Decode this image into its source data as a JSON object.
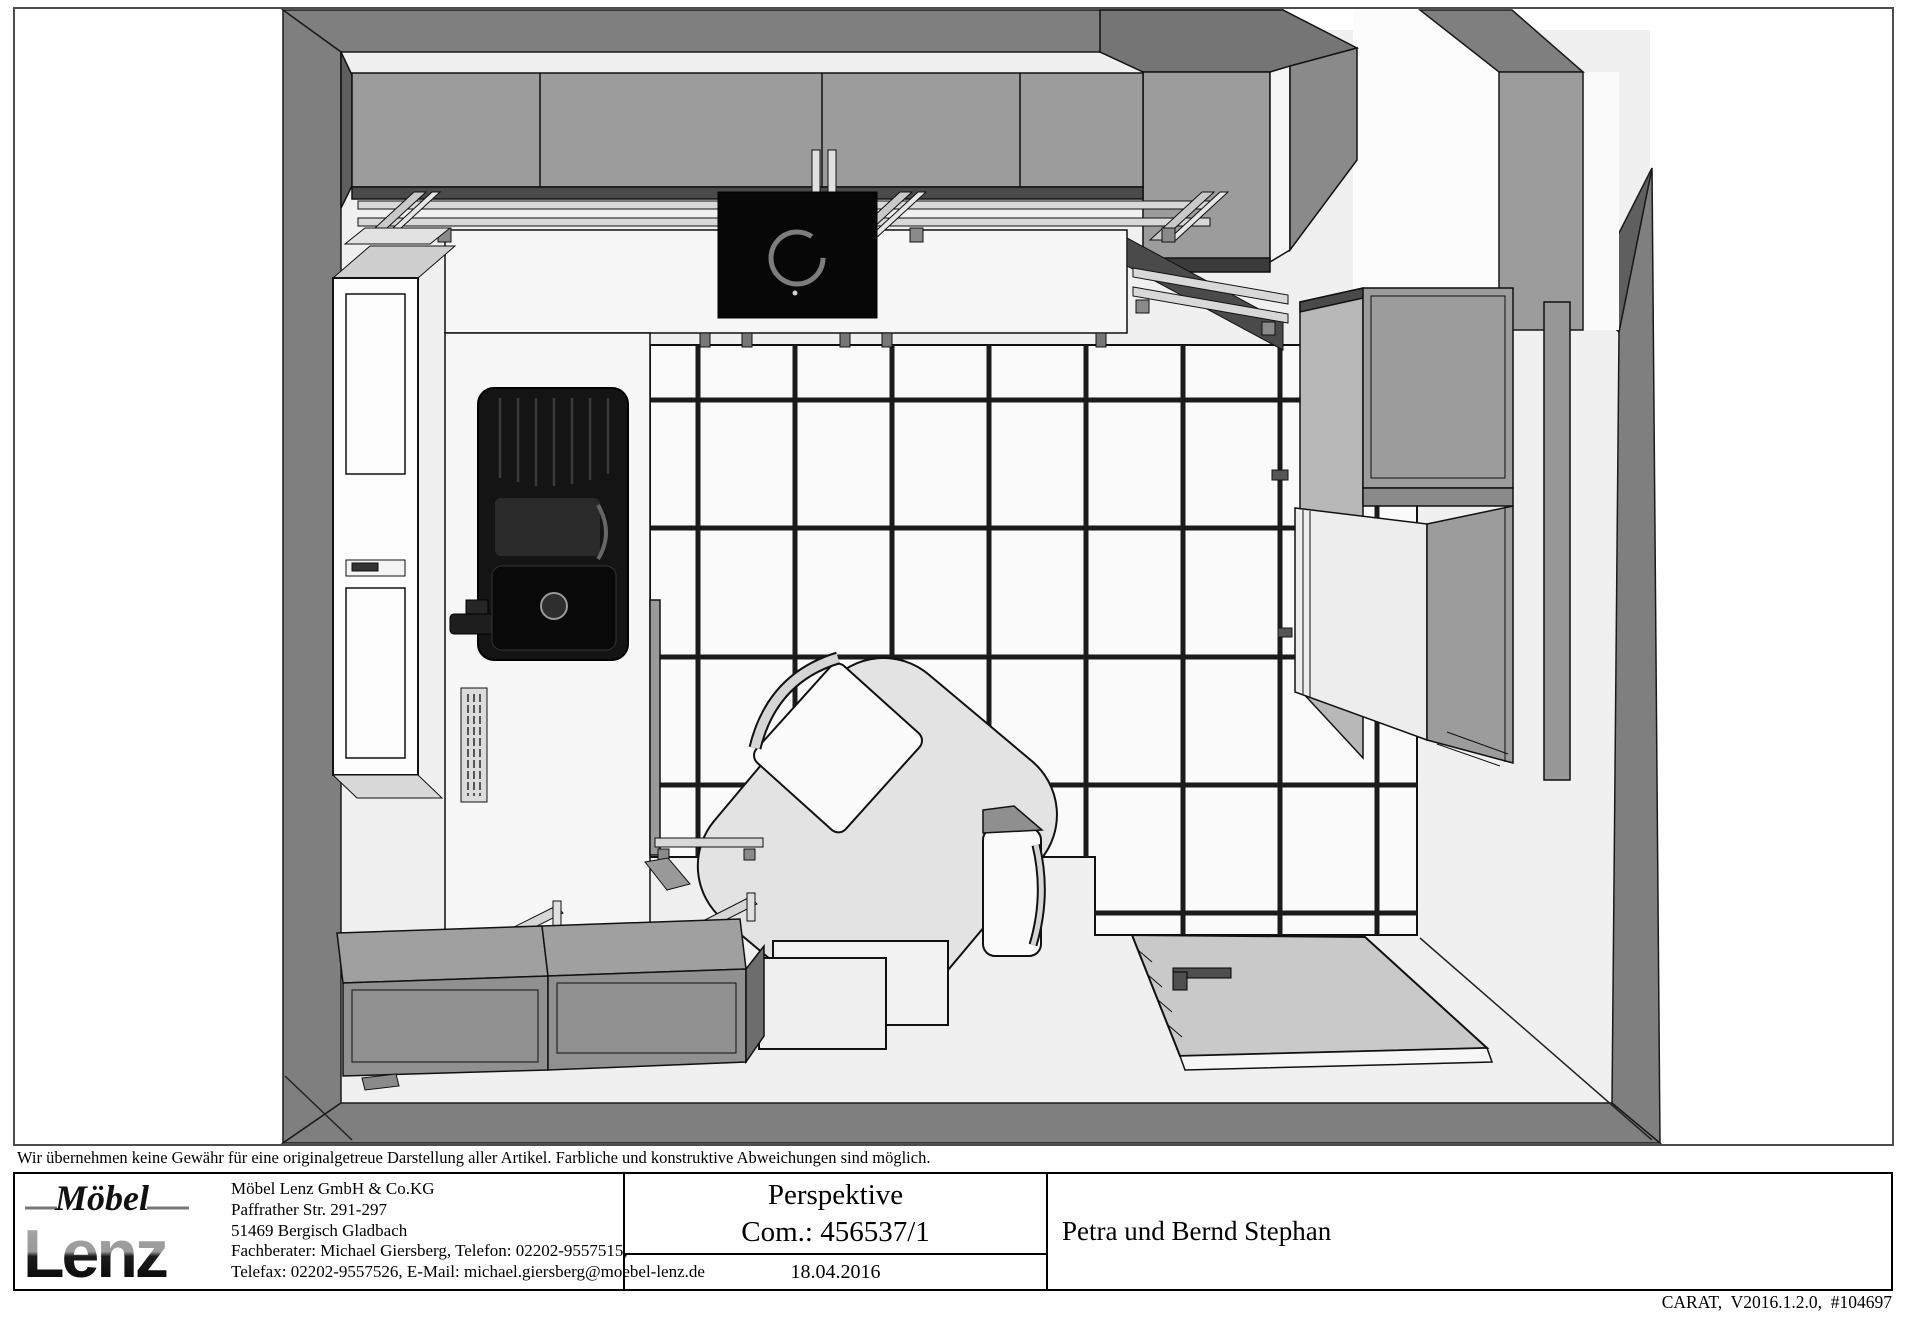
{
  "disclaimer": "Wir übernehmen keine Gewähr für eine originalgetreue Darstellung aller Artikel. Farbliche und konstruktive Abweichungen sind möglich.",
  "title_block": {
    "logo_word_top": "Möbel",
    "logo_word_bottom": "Lenz",
    "company_name": "Möbel Lenz GmbH & Co.KG",
    "company_street": "Paffrather Str. 291-297",
    "company_city": "51469 Bergisch Gladbach",
    "company_consultant": "Fachberater: Michael Giersberg, Telefon: 02202-9557515,",
    "company_fax_email": "Telefax: 02202-9557526, E-Mail: michael.giersberg@moebel-lenz.de",
    "view_label": "Perspektive",
    "commission": "Com.: 456537/1",
    "date": "18.04.2016",
    "customer_name": "Petra und Bernd Stephan"
  },
  "footer_note": "CARAT,  V2016.1.2.0,  #104697",
  "drawing": {
    "subject": "kitchen-perspective-top-view",
    "palette": {
      "wall_band": "#7f7f7f",
      "cabinet_front": "#9c9c9c",
      "counter": "#f7f7f7",
      "floor_tile": "#fafafa",
      "grout": "#1b1b1b",
      "appliance_black": "#0a0a0a",
      "table": "#e3e3e3",
      "chair": "#fbfbfb"
    }
  }
}
